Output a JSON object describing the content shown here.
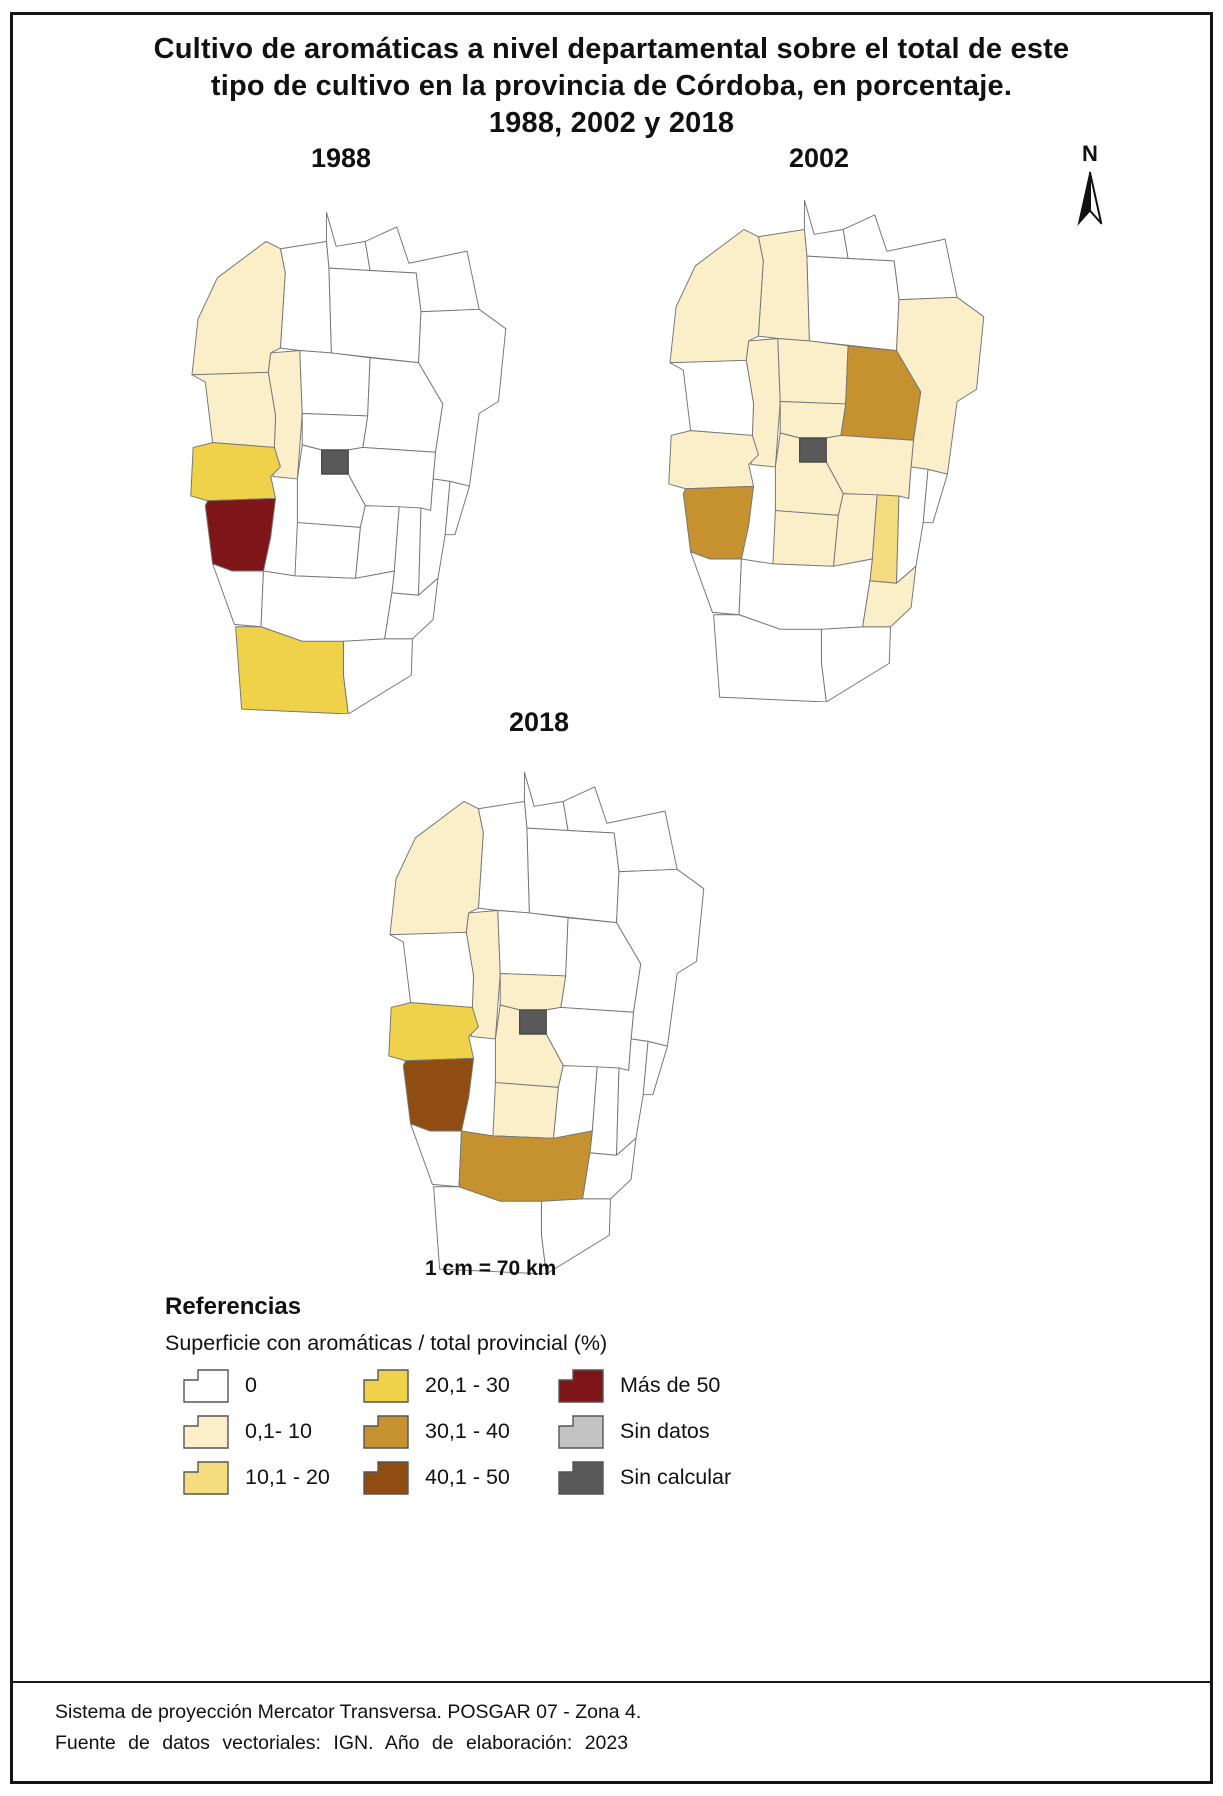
{
  "title": {
    "lines": [
      "Cultivo de aromáticas a nivel departamental sobre el total de este",
      "tipo de cultivo en la provincia de Córdoba, en porcentaje.",
      "1988, 2002 y 2018"
    ]
  },
  "north_arrow": {
    "label": "N"
  },
  "scale_text": "1 cm = 70 km",
  "maps": [
    {
      "year": "1988"
    },
    {
      "year": "2002"
    },
    {
      "year": "2018"
    }
  ],
  "classes": {
    "c0": {
      "label": "0",
      "color": "#FFFFFF"
    },
    "c1": {
      "label": "0,1- 10",
      "color": "#FAEFC9"
    },
    "c2": {
      "label": "10,1 - 20",
      "color": "#F6DC81"
    },
    "c3": {
      "label": "20,1 - 30",
      "color": "#EFD24A"
    },
    "c4": {
      "label": "30,1 - 40",
      "color": "#C5922F"
    },
    "c5": {
      "label": "40,1 - 50",
      "color": "#8F4D12"
    },
    "c6": {
      "label": "Más de 50",
      "color": "#7E1518"
    },
    "c7": {
      "label": "Sin datos",
      "color": "#C2C2C2"
    },
    "c8": {
      "label": "Sin calcular",
      "color": "#595959"
    }
  },
  "map_fills": {
    "1988": {
      "cruz-del-eje": "c1",
      "minas": "c1",
      "punilla": "c1",
      "pocho": "c3",
      "san-alberto": "c6",
      "general-roca": "c3",
      "capital": "c8"
    },
    "2002": {
      "cruz-del-eje": "c1",
      "ischilin": "c1",
      "punilla": "c1",
      "totoral": "c1",
      "colon": "c1",
      "pocho": "c1",
      "santa-maria": "c1",
      "rio-segundo": "c1",
      "san-justo": "c1",
      "tercero-arriba": "c1",
      "juarez-celman": "c1",
      "calamuchita": "c1",
      "san-alberto": "c4",
      "rio-primero": "c4",
      "general-san-martin": "c2",
      "capital": "c8"
    },
    "2018": {
      "cruz-del-eje": "c1",
      "punilla": "c1",
      "colon": "c1",
      "santa-maria": "c1",
      "calamuchita": "c1",
      "pocho": "c3",
      "san-alberto": "c5",
      "rio-cuarto": "c4",
      "capital": "c8"
    }
  },
  "legend": {
    "heading": "Referencias",
    "subtitle": "Superficie con aromáticas / total provincial (%)",
    "items": [
      {
        "label": "0",
        "class": "c0"
      },
      {
        "label": "0,1- 10",
        "class": "c1"
      },
      {
        "label": "10,1 - 20",
        "class": "c2"
      },
      {
        "label": "20,1 - 30",
        "class": "c3"
      },
      {
        "label": "30,1 - 40",
        "class": "c4"
      },
      {
        "label": "40,1 - 50",
        "class": "c5"
      },
      {
        "label": "Más de 50",
        "class": "c6"
      },
      {
        "label": "Sin datos",
        "class": "c7"
      },
      {
        "label": "Sin calcular",
        "class": "c8"
      }
    ]
  },
  "footer": {
    "line1": "Sistema de proyección Mercator Transversa. POSGAR 07 - Zona 4.",
    "line2": "Fuente de datos vectoriales:  IGN.  Año de elaboración:  2023"
  }
}
